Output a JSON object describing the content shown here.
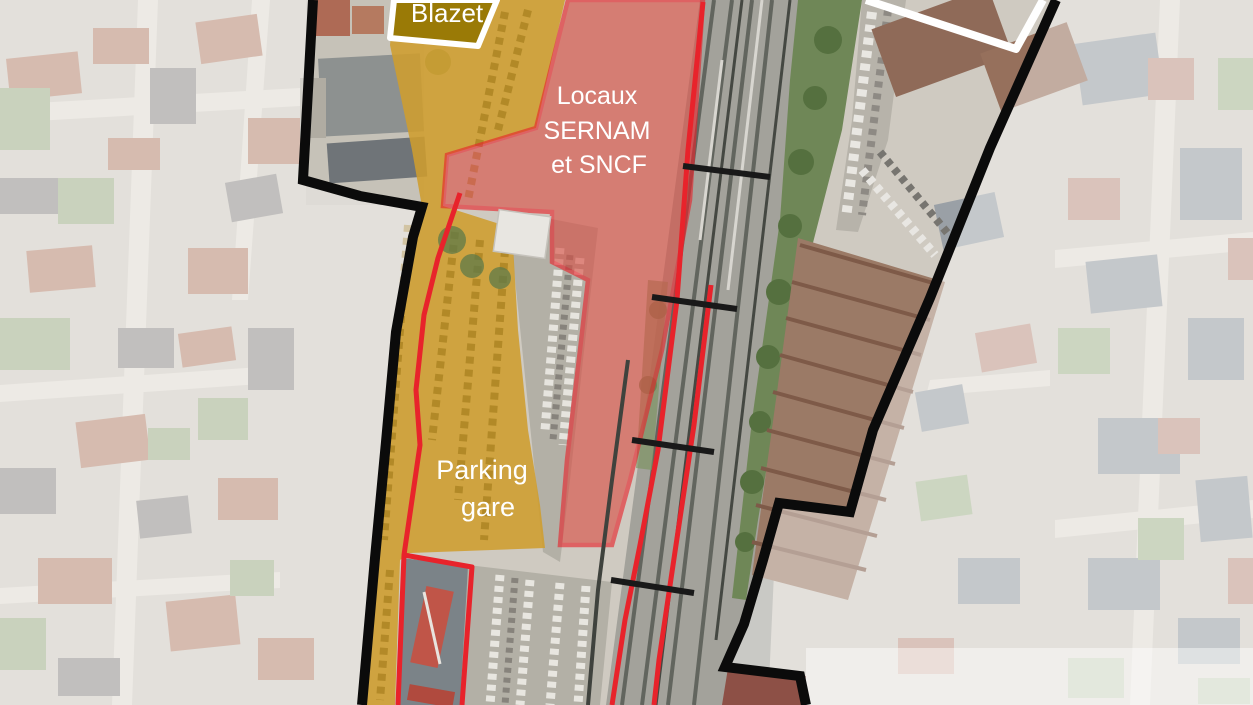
{
  "map": {
    "type": "annotated-aerial-map",
    "labels": {
      "blazet": "Blazet",
      "sernam_line1": "Locaux",
      "sernam_line2": "SERNAM",
      "sernam_line3": "et SNCF",
      "parking_line1": "Parking",
      "parking_line2": "gare"
    },
    "zones": [
      {
        "name": "Blazet",
        "style": "white-outline-yellow-fill"
      },
      {
        "name": "Locaux SERNAM et SNCF",
        "style": "red-overlay"
      },
      {
        "name": "Parking gare",
        "style": "yellow-overlay"
      },
      {
        "name": "study-perimeter",
        "style": "black-outline"
      },
      {
        "name": "north-east-parcel",
        "style": "white-outline"
      }
    ],
    "colors": {
      "perimeter_black": "#0b0b0b",
      "overlay_yellow": "#cf9d2e",
      "overlay_red_fill": "#d94f45",
      "outline_red": "#e8232b",
      "outline_white": "#ffffff",
      "railway_grey": "#a3a29b",
      "faded_background": "#d7d2ca"
    }
  }
}
